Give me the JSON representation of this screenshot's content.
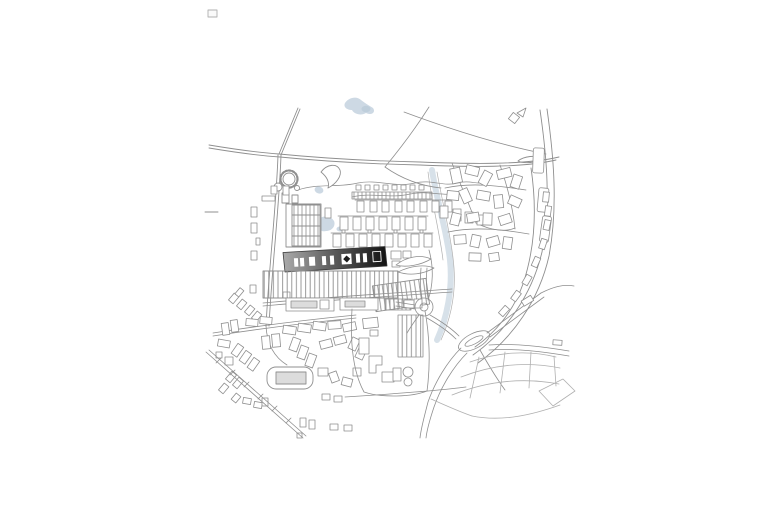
{
  "document": {
    "title": "Urban site plan — monochrome figure-ground drawing",
    "description": "Architectural site plan with the project building highlighted as a dark gradient bar",
    "background": "#ffffff"
  },
  "colors": {
    "background": "#ffffff",
    "line": "#8f8f8f",
    "line_light": "#b0b0b0",
    "line_dark": "#3a3a3a",
    "water": "#cdd9e4",
    "water_edge": "#b8c9d8",
    "building_fill": "#ffffff",
    "inner_fill": "#dcdcdc",
    "highlight_start": "#ababab",
    "highlight_mid": "#606060",
    "highlight_end": "#121212",
    "slot_dark": "#1c1c1c"
  },
  "map": {
    "kind": "architectural-site-plan",
    "style": "monochrome line drawing, no labels",
    "highlight_building_label": "project-site-building",
    "features": [
      {
        "name": "main-road-north",
        "kind": "road"
      },
      {
        "name": "ring-road-east",
        "kind": "road"
      },
      {
        "name": "railway-southwest",
        "kind": "rail"
      },
      {
        "name": "roundabout-west",
        "kind": "junction"
      },
      {
        "name": "roundabout-oval-east",
        "kind": "junction"
      },
      {
        "name": "pond-north",
        "kind": "water"
      },
      {
        "name": "pond-central",
        "kind": "water"
      },
      {
        "name": "stream-east",
        "kind": "water"
      },
      {
        "name": "gasometer-circle",
        "kind": "structure"
      },
      {
        "name": "factory-hatched-block",
        "kind": "buildings"
      },
      {
        "name": "factory-comb-rows",
        "kind": "buildings"
      },
      {
        "name": "saw-tooth-sheds",
        "kind": "buildings"
      },
      {
        "name": "highlight-building",
        "kind": "project"
      },
      {
        "name": "residential-southwest",
        "kind": "buildings"
      },
      {
        "name": "stadium-building",
        "kind": "buildings"
      },
      {
        "name": "campus-east",
        "kind": "buildings"
      },
      {
        "name": "field-parcels-southeast",
        "kind": "landscape"
      }
    ]
  }
}
